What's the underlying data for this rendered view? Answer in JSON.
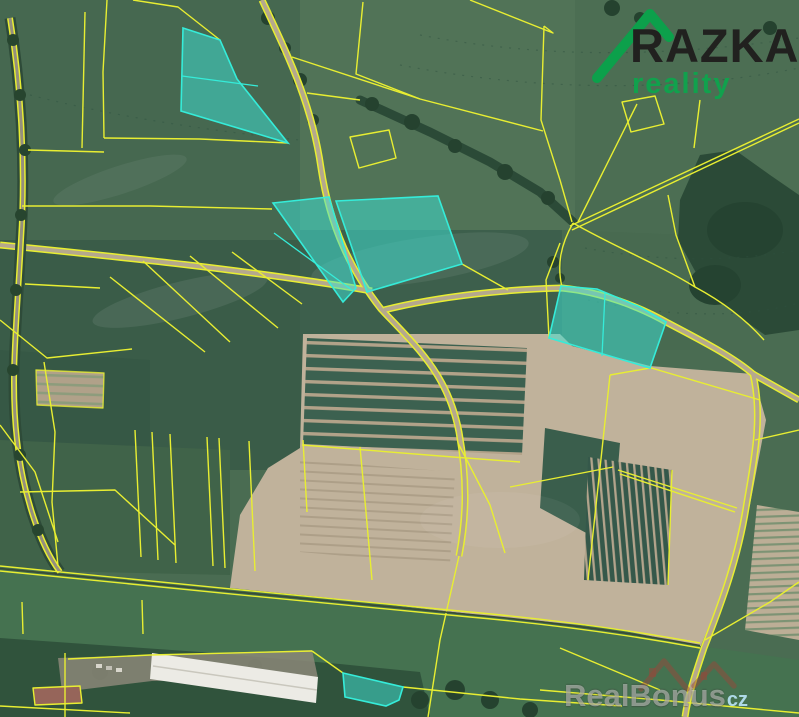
{
  "page": {
    "width": 799,
    "height": 717,
    "kind": "aerial-cadastral-map"
  },
  "logo": {
    "brand": "RAZKA",
    "tagline": "reality",
    "brand_color": "#21211f",
    "tagline_color": "#11a14d",
    "peak_color": "#0ca04b"
  },
  "watermark": {
    "brand": "RealBonus",
    "suffix": "cz",
    "suffix_color": "#aed9e6",
    "icon_color": "rgba(150,72,58,0.5)"
  },
  "map": {
    "parcel_line_color": "#e8ee32",
    "highlight_fill": "rgba(62,226,213,0.52)",
    "highlight_stroke": "#35ecd9",
    "highlighted_parcels": [
      {
        "id": "highlighted-parcel-1",
        "points": "183,28 220,40 237,79 288,143 181,111",
        "dividers": [
          "182,76 258,86"
        ]
      },
      {
        "id": "highlighted-parcel-2",
        "points": "273,203 329,197 356,288 343,302",
        "dividers": [
          "274,233 352,290"
        ]
      },
      {
        "id": "highlighted-parcel-3",
        "points": "336,201 438,196 462,264 367,292"
      },
      {
        "id": "highlighted-parcel-4",
        "points": "561,286 597,289 640,307 666,322 650,368 549,338",
        "dividers": [
          "605,293 602,356"
        ]
      },
      {
        "id": "highlighted-parcel-5",
        "points": "343,673 403,687 399,700 386,706 345,697"
      }
    ]
  }
}
